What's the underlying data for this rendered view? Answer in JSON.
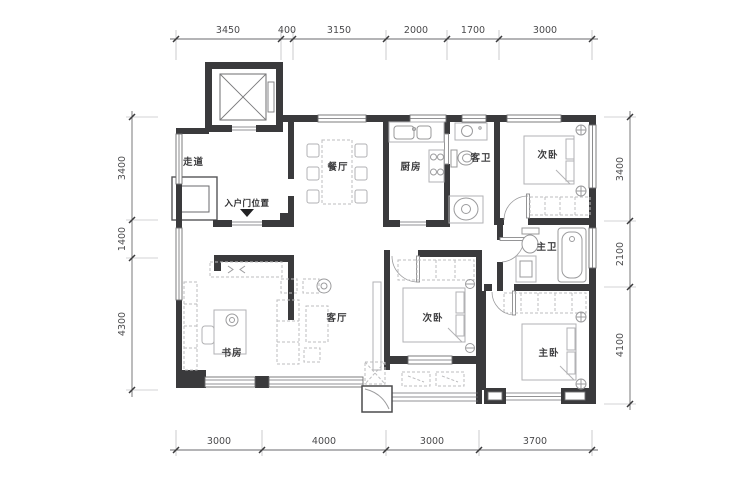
{
  "plan": {
    "rooms": {
      "corridor": "走道",
      "dining": "餐厅",
      "kitchen": "厨房",
      "guest_bath": "客卫",
      "bedroom_top": "次卧",
      "master_bath": "主卫",
      "master_bedroom": "主卧",
      "bedroom_mid": "次卧",
      "living": "客厅",
      "study": "书房"
    },
    "entry_label": "入户门位置",
    "dims": {
      "top": [
        "3450",
        "400",
        "3150",
        "2000",
        "1700",
        "3000"
      ],
      "bottom": [
        "3000",
        "4000",
        "3000",
        "3700"
      ],
      "left": [
        "3400",
        "1400",
        "4300"
      ],
      "right": [
        "3400",
        "2100",
        "4100"
      ]
    },
    "colors": {
      "wall": "#3a3a3c",
      "furniture": "#b5b5b7",
      "dimension": "#4b4b4d"
    }
  }
}
